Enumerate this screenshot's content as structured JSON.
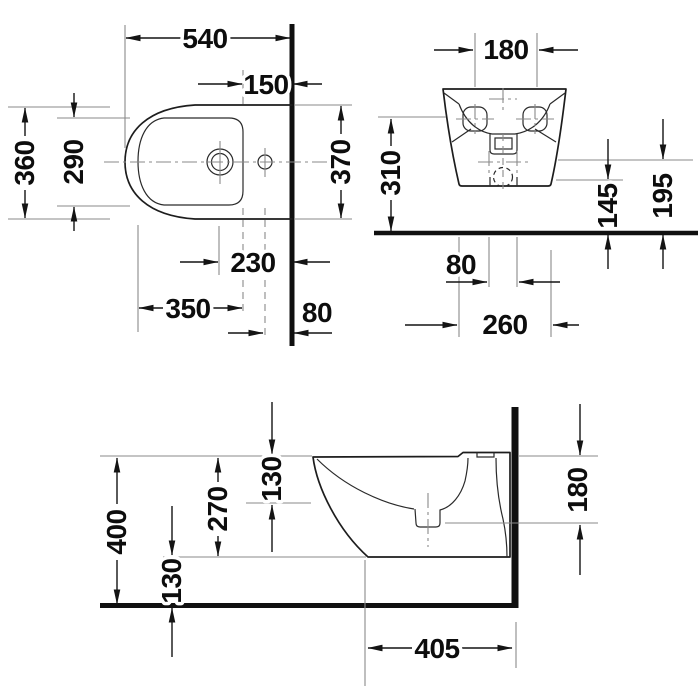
{
  "style": {
    "background": "#ffffff",
    "outline_color": "#1d1d1d",
    "dimension_color": "#141414",
    "extension_color": "#8a8a8a",
    "wall_floor_color": "#101010"
  },
  "views": {
    "plan": {
      "dims": {
        "overall_depth": "540",
        "rim_back_to_wall": "150",
        "outer_width": "360",
        "inner_rim_width": "290",
        "outer_width_at_wall": "370",
        "tap_center_to_wall": "230",
        "inner_rim_length": "350",
        "side_hole_to_wall": "80"
      }
    },
    "front": {
      "dims": {
        "fixing_holes_spacing": "180",
        "fixing_holes_height": "310",
        "outlet_center_height": "145",
        "bolts_height": "195",
        "bolts_spacing": "80",
        "base_width": "260"
      }
    },
    "side": {
      "dims": {
        "rim_height": "400",
        "rim_to_bowl_depth": "130",
        "rim_to_underside": "270",
        "underside_to_floor": "130",
        "rim_to_outlet_axis": "180",
        "overall_projection": "405"
      }
    }
  }
}
